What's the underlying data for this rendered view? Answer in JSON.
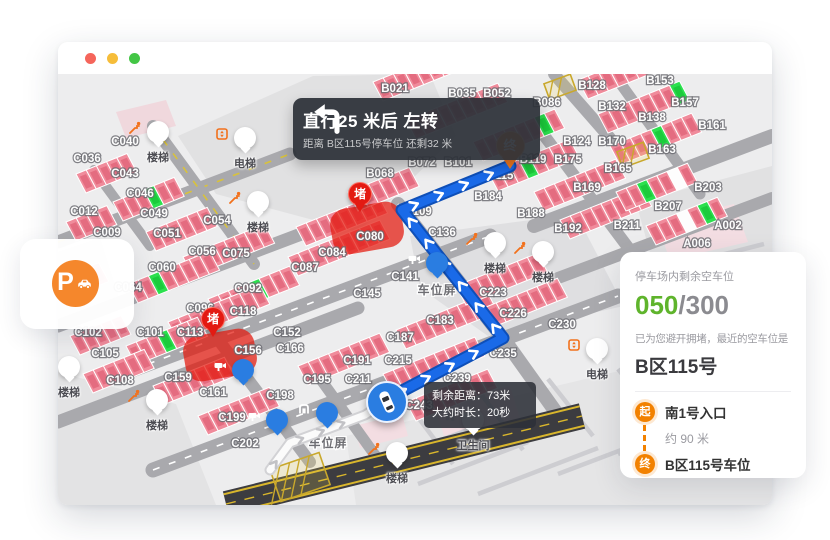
{
  "window": {
    "traffic_dots": [
      "#f5655b",
      "#f6bd3a",
      "#43c645"
    ]
  },
  "banner": {
    "title": "直行25 米后 左转",
    "subtitle": "距离 B区115号停车位 还剩32 米"
  },
  "eta_tooltip": {
    "line1": "剩余距离：73米",
    "line2": "大约时长：20秒"
  },
  "parking_fab": {
    "letter": "P",
    "color": "#f5872c"
  },
  "info_panel": {
    "remaining_label": "停车场内剩余空车位",
    "available": "050",
    "separator": "/",
    "total": "300",
    "available_color": "#5fb42c",
    "avoid_text": "已为您避开拥堵，最近的空车位是",
    "spot_name": "B区115号",
    "route": {
      "start_badge": "起",
      "start_label": "南1号入口",
      "distance_label": "约 90 米",
      "end_badge": "终",
      "end_label": "B区115号车位"
    }
  },
  "map": {
    "colors": {
      "route": "#1a6ae8",
      "route_border": "#0e4fb8",
      "occupied": "#f08b9b",
      "occupied_dark": "#e06277",
      "free": "#2ce04e",
      "free_dark": "#17c437",
      "congestion": "#e3170d",
      "road": "#a9a9ad",
      "accent_orange": "#f2711c"
    },
    "route_points": [
      [
        327,
        326
      ],
      [
        445,
        264
      ],
      [
        344,
        136
      ],
      [
        452,
        92
      ]
    ],
    "traveled_points": [
      [
        212,
        396
      ],
      [
        232,
        369
      ],
      [
        307,
        341
      ],
      [
        327,
        328
      ]
    ],
    "destination_pin": {
      "x": 452,
      "y": 71,
      "label": "终"
    },
    "jam_label": "堵",
    "jams": [
      {
        "x": 302,
        "y": 122,
        "bx": 309,
        "by": 154
      },
      {
        "x": 155,
        "y": 247,
        "bx": 162,
        "by": 281
      }
    ],
    "spot_labels": [
      {
        "t": "C040",
        "x": 67,
        "y": 67
      },
      {
        "t": "C036",
        "x": 29,
        "y": 84
      },
      {
        "t": "C043",
        "x": 67,
        "y": 99
      },
      {
        "t": "C046",
        "x": 82,
        "y": 119
      },
      {
        "t": "C012",
        "x": 26,
        "y": 137
      },
      {
        "t": "C049",
        "x": 96,
        "y": 139
      },
      {
        "t": "C009",
        "x": 49,
        "y": 158
      },
      {
        "t": "C051",
        "x": 109,
        "y": 159
      },
      {
        "t": "C054",
        "x": 159,
        "y": 146
      },
      {
        "t": "C056",
        "x": 144,
        "y": 177
      },
      {
        "t": "C075",
        "x": 178,
        "y": 179
      },
      {
        "t": "C060",
        "x": 104,
        "y": 193
      },
      {
        "t": "C064",
        "x": 70,
        "y": 213
      },
      {
        "t": "C092",
        "x": 190,
        "y": 214
      },
      {
        "t": "C096",
        "x": 142,
        "y": 234
      },
      {
        "t": "C118",
        "x": 185,
        "y": 237
      },
      {
        "t": "C087",
        "x": 247,
        "y": 193
      },
      {
        "t": "C084",
        "x": 274,
        "y": 178
      },
      {
        "t": "C080",
        "x": 312,
        "y": 162
      },
      {
        "t": "C136",
        "x": 384,
        "y": 158
      },
      {
        "t": "C141",
        "x": 347,
        "y": 202
      },
      {
        "t": "C145",
        "x": 309,
        "y": 219
      },
      {
        "t": "C102",
        "x": 30,
        "y": 258
      },
      {
        "t": "C101",
        "x": 92,
        "y": 258
      },
      {
        "t": "C113",
        "x": 132,
        "y": 258
      },
      {
        "t": "C105",
        "x": 47,
        "y": 279
      },
      {
        "t": "C152",
        "x": 229,
        "y": 258
      },
      {
        "t": "C156",
        "x": 190,
        "y": 276
      },
      {
        "t": "C166",
        "x": 232,
        "y": 274
      },
      {
        "t": "C108",
        "x": 62,
        "y": 306
      },
      {
        "t": "C159",
        "x": 120,
        "y": 303
      },
      {
        "t": "C161",
        "x": 155,
        "y": 318
      },
      {
        "t": "C198",
        "x": 222,
        "y": 321
      },
      {
        "t": "C199",
        "x": 174,
        "y": 343
      },
      {
        "t": "C202",
        "x": 187,
        "y": 369
      },
      {
        "t": "C191",
        "x": 299,
        "y": 286
      },
      {
        "t": "C195",
        "x": 259,
        "y": 305
      },
      {
        "t": "C211",
        "x": 300,
        "y": 305
      },
      {
        "t": "C183",
        "x": 382,
        "y": 246
      },
      {
        "t": "C187",
        "x": 342,
        "y": 263
      },
      {
        "t": "C215",
        "x": 340,
        "y": 286
      },
      {
        "t": "C223",
        "x": 435,
        "y": 218
      },
      {
        "t": "C226",
        "x": 455,
        "y": 239
      },
      {
        "t": "C230",
        "x": 504,
        "y": 250
      },
      {
        "t": "C235",
        "x": 445,
        "y": 279
      },
      {
        "t": "C239",
        "x": 399,
        "y": 304
      },
      {
        "t": "C243",
        "x": 361,
        "y": 331
      },
      {
        "t": "B021",
        "x": 337,
        "y": 14
      },
      {
        "t": "B035",
        "x": 404,
        "y": 19
      },
      {
        "t": "B052",
        "x": 439,
        "y": 19
      },
      {
        "t": "B086",
        "x": 489,
        "y": 28
      },
      {
        "t": "B128",
        "x": 534,
        "y": 11
      },
      {
        "t": "B132",
        "x": 554,
        "y": 32
      },
      {
        "t": "B124",
        "x": 519,
        "y": 67
      },
      {
        "t": "B170",
        "x": 554,
        "y": 67
      },
      {
        "t": "B119",
        "x": 475,
        "y": 85
      },
      {
        "t": "B175",
        "x": 510,
        "y": 85
      },
      {
        "t": "B165",
        "x": 560,
        "y": 94
      },
      {
        "t": "B072",
        "x": 364,
        "y": 88
      },
      {
        "t": "B101",
        "x": 400,
        "y": 88
      },
      {
        "t": "B115",
        "x": 442,
        "y": 101
      },
      {
        "t": "B169",
        "x": 529,
        "y": 113
      },
      {
        "t": "B153",
        "x": 602,
        "y": 6
      },
      {
        "t": "B157",
        "x": 627,
        "y": 28
      },
      {
        "t": "B161",
        "x": 654,
        "y": 51
      },
      {
        "t": "B138",
        "x": 594,
        "y": 43
      },
      {
        "t": "B163",
        "x": 604,
        "y": 75
      },
      {
        "t": "B203",
        "x": 650,
        "y": 113
      },
      {
        "t": "B207",
        "x": 610,
        "y": 132
      },
      {
        "t": "B211",
        "x": 569,
        "y": 151
      },
      {
        "t": "A002",
        "x": 670,
        "y": 151
      },
      {
        "t": "A006",
        "x": 639,
        "y": 169
      },
      {
        "t": "B184",
        "x": 430,
        "y": 122
      },
      {
        "t": "B188",
        "x": 473,
        "y": 139
      },
      {
        "t": "B192",
        "x": 510,
        "y": 154
      },
      {
        "t": "B068",
        "x": 322,
        "y": 99
      },
      {
        "t": "B109",
        "x": 360,
        "y": 137
      }
    ],
    "area_labels": [
      {
        "l": "车位屏",
        "x": 379,
        "y": 216
      },
      {
        "l": "车位屏",
        "x": 270,
        "y": 369
      }
    ],
    "markers": [
      {
        "t": "stairs",
        "l": "楼梯",
        "x": 100,
        "y": 58
      },
      {
        "t": "elevator",
        "l": "电梯",
        "x": 187,
        "y": 64
      },
      {
        "t": "stairs",
        "l": "楼梯",
        "x": 200,
        "y": 128
      },
      {
        "t": "stairs",
        "l": "楼梯",
        "x": 437,
        "y": 169
      },
      {
        "t": "stairs",
        "l": "楼梯",
        "x": 485,
        "y": 178
      },
      {
        "t": "elevator",
        "l": "电梯",
        "x": 539,
        "y": 275
      },
      {
        "t": "stairs",
        "l": "楼梯",
        "x": 11,
        "y": 293
      },
      {
        "t": "stairs",
        "l": "楼梯",
        "x": 99,
        "y": 326
      },
      {
        "t": "stairs",
        "l": "楼梯",
        "x": 339,
        "y": 379
      },
      {
        "t": "camera",
        "l": "",
        "x": 185,
        "y": 296
      },
      {
        "t": "camera",
        "l": "",
        "x": 219,
        "y": 346
      },
      {
        "t": "camera",
        "l": "",
        "x": 379,
        "y": 189
      },
      {
        "t": "gate",
        "l": "",
        "x": 269,
        "y": 339
      },
      {
        "t": "wc",
        "l": "卫生间",
        "x": 415,
        "y": 346
      }
    ]
  }
}
